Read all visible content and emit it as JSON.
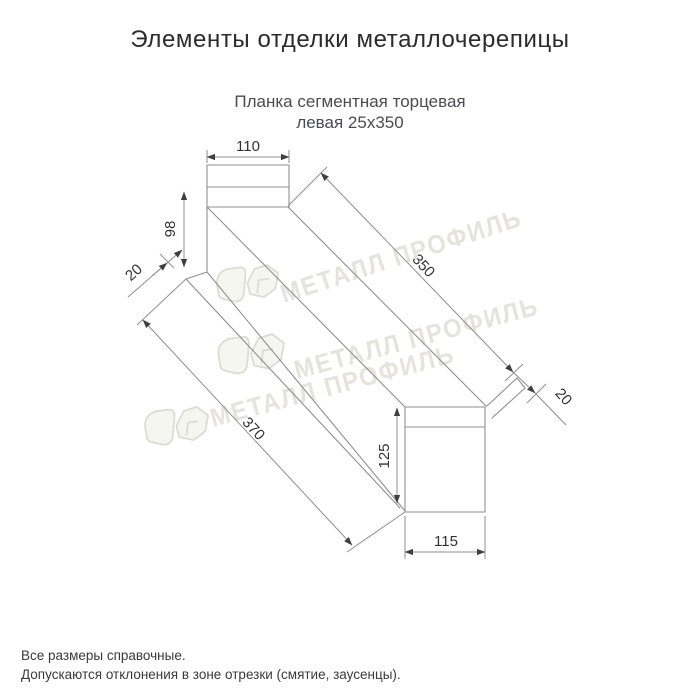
{
  "page": {
    "background": "#ffffff"
  },
  "header": {
    "title": "Элементы отделки металлочерепицы"
  },
  "product": {
    "subtitle_line1": "Планка сегментная торцевая",
    "subtitle_line2": "левая 25x350"
  },
  "diagram": {
    "type": "technical-drawing",
    "dimensions": {
      "top_tab_width": "110",
      "vertical_face_height": "98",
      "near_flange_width": "20",
      "segment_length": "350",
      "far_flange_width": "20",
      "overall_length": "370",
      "end_face_height": "125",
      "end_face_width": "115"
    },
    "watermark_text": "МЕТАЛЛ ПРОФИЛЬ",
    "colors": {
      "line": "#8f8f8f",
      "label": "#333333",
      "watermark": "#e4e4dd",
      "title": "#2b2b2b",
      "subtitle": "#4b4b52"
    }
  },
  "footer": {
    "note_line1": "Все размеры справочные.",
    "note_line2": "Допускаются отклонения в зоне отрезки (смятие, заусенцы)."
  }
}
